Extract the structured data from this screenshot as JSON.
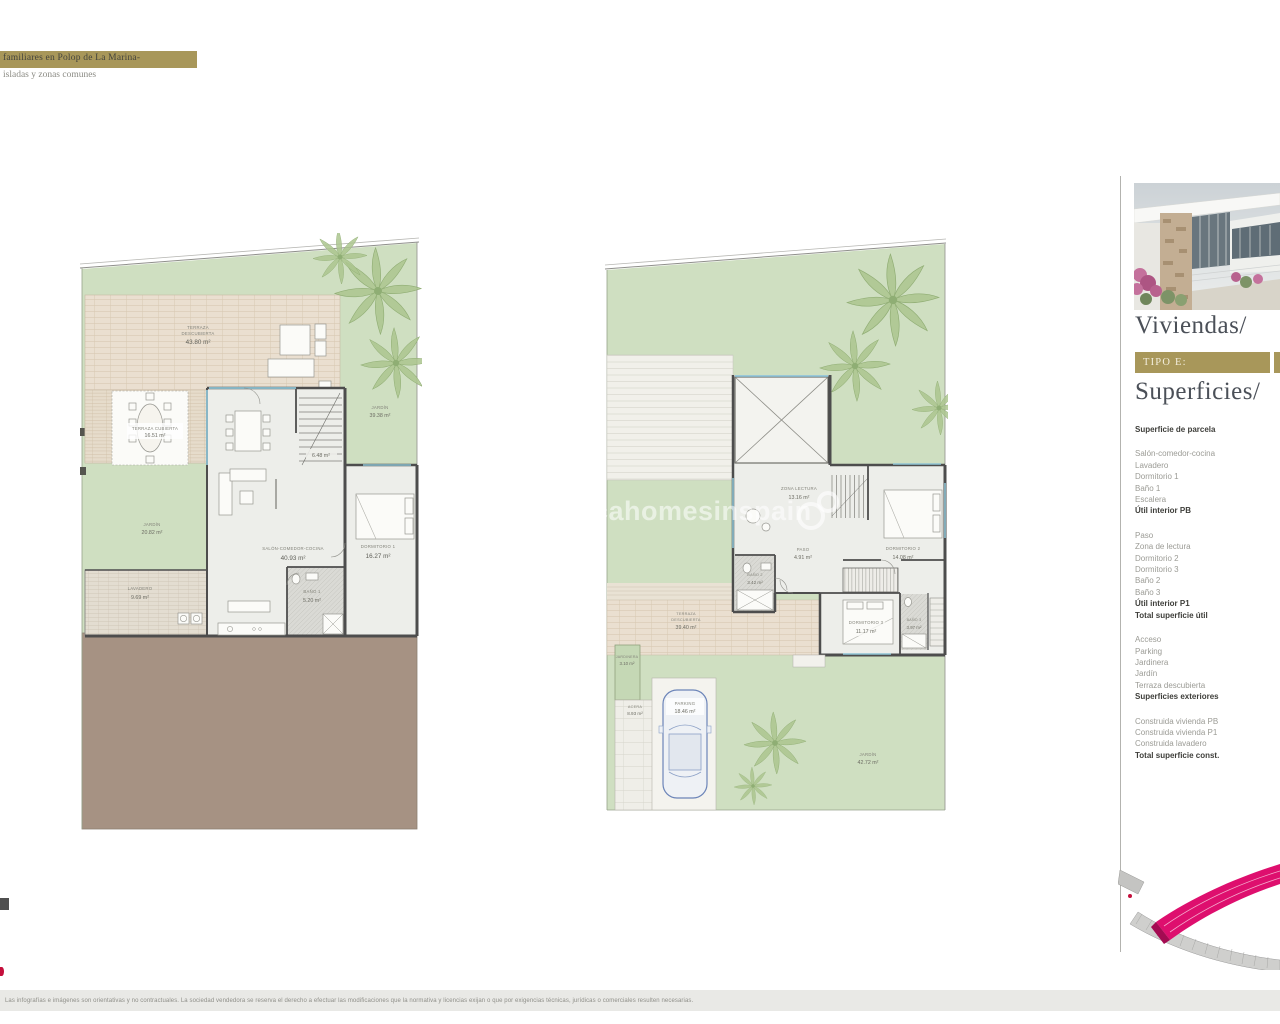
{
  "header": {
    "line1": "familiares en Polop de La Marina-",
    "line2": "isladas y zonas comunes"
  },
  "sidebar": {
    "title": "Viviendas/",
    "type_badge": "TIPO E:",
    "subtitle": "Superficies/",
    "rows": [
      {
        "label": "Superficie de parcela"
      },
      {
        "label": "Salón-comedor-cocina"
      },
      {
        "label": "Lavadero"
      },
      {
        "label": "Dormitorio 1"
      },
      {
        "label": "Baño 1"
      },
      {
        "label": "Escalera"
      },
      {
        "label": "Útil interior PB"
      },
      {
        "label": "Paso"
      },
      {
        "label": "Zona de lectura"
      },
      {
        "label": "Dormitorio 2"
      },
      {
        "label": "Dormitorio 3"
      },
      {
        "label": "Baño 2"
      },
      {
        "label": "Baño 3"
      },
      {
        "label": "Útil interior P1"
      },
      {
        "label": "Total superficie útil"
      },
      {
        "label": "Acceso"
      },
      {
        "label": "Parking"
      },
      {
        "label": "Jardinera"
      },
      {
        "label": "Jardín"
      },
      {
        "label": "Terraza descubierta"
      },
      {
        "label": "Superficies exteriores"
      },
      {
        "label": "Construida vivienda PB"
      },
      {
        "label": "Construida vivienda P1"
      },
      {
        "label": "Construida lavadero"
      },
      {
        "label": "Total superficie const."
      }
    ]
  },
  "plan_pb": {
    "terraza_line1": "TERRAZA",
    "terraza_line2": "DESCUBIERTA",
    "terraza_value": "43.80 m²",
    "porche_line1": "TERRAZA CUBIERTA",
    "porche_value": "16.51 m²",
    "salon_line1": "SALÓN-COMEDOR-COCINA",
    "salon_value": "40.93 m²",
    "dorm1_line1": "DORMITORIO 1",
    "dorm1_value": "16.27 m²",
    "bano1_line1": "BAÑO 1",
    "bano1_value": "5.20 m²",
    "lavadero_line1": "LAVADERO",
    "lavadero_value": "9.69 m²",
    "escalera_value": "6.48 m²",
    "jardin_left_line1": "JARDÍN",
    "jardin_left_value": "20.82 m²",
    "jardin_right_line1": "JARDÍN",
    "jardin_right_value": "39.38 m²"
  },
  "plan_p1": {
    "zona_line1": "ZONA LECTURA",
    "zona_value": "13.16 m²",
    "paso_line1": "PASO",
    "paso_value": "4.91 m²",
    "dorm2_line1": "DORMITORIO 2",
    "dorm2_value": "14.08 m²",
    "bano2_line1": "BAÑO 2",
    "bano2_value": "3.42 m²",
    "dorm3_line1": "DORMITORIO 3",
    "dorm3_value": "11.17 m²",
    "bano3_line1": "BAÑO 3",
    "bano3_value": "3.97 m²",
    "terraza_line1": "TERRAZA",
    "terraza_line2": "DESCUBIERTA",
    "terraza_value": "39.40 m²",
    "jardinera_line1": "JARDINERA",
    "jardinera_value": "3.10 m²",
    "acera_line1": "ACERA",
    "acera_value": "8.93 m²",
    "parking_line1": "PARKING",
    "parking_value": "18.46 m²",
    "jardin_line1": "JARDÍN",
    "jardin_value": "42.72 m²"
  },
  "watermark": {
    "text": "ncahomesinspain"
  },
  "footer": {
    "disclaimer": "Las infografías e imágenes son orientativas y no contractuales. La sociedad vendedora se reserva el derecho a efectuar las modificaciones que la normativa y licencias exijan o que por exigencias técnicas, jurídicas o comerciales resulten necesarias."
  },
  "colors": {
    "accent_gold": "#a8975a",
    "headline": "#4b5058",
    "magenta": "#de0f6e",
    "plan_green": "#cfdfc1",
    "terrace_beige": "#eadfd0",
    "wall_gray": "#4d4d4d",
    "ground_brown": "#a69283"
  }
}
